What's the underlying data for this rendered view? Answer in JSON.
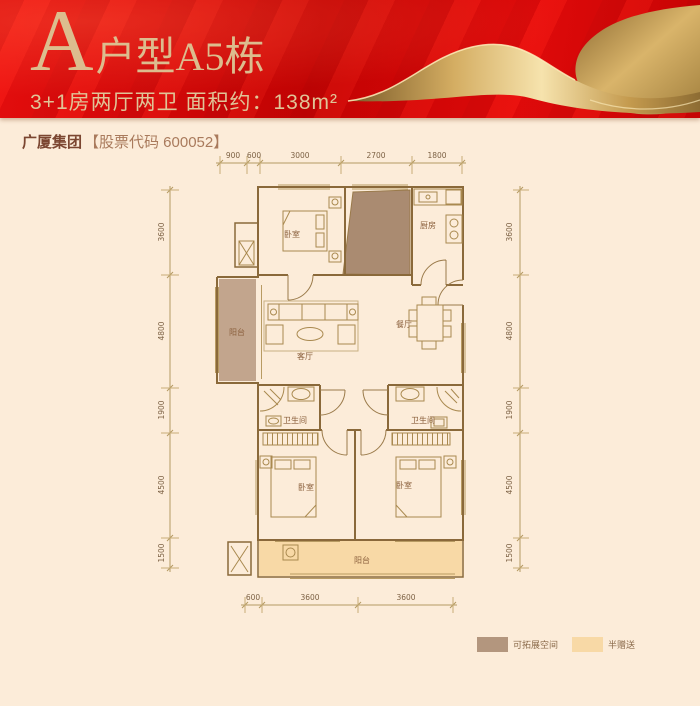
{
  "header": {
    "title_letter": "A",
    "title_rest": "户型A5栋",
    "subtitle": "3+1房两厅两卫 面积约：138m²"
  },
  "company": {
    "name": "广厦集团",
    "stock": "【股票代码 600052】"
  },
  "plan": {
    "rooms": {
      "bedroom_top": "卧室",
      "kitchen": "厨房",
      "balcony_left": "阳台",
      "living": "客厅",
      "dining": "餐厅",
      "bath_left": "卫生间",
      "bath_right": "卫生间",
      "bedroom_left": "卧室",
      "bedroom_right": "卧室",
      "balcony_bottom": "阳台"
    },
    "dims": {
      "top": [
        "900",
        "600",
        "3000",
        "2700",
        "1800"
      ],
      "left": [
        "3600",
        "4800",
        "1900",
        "4500",
        "1500"
      ],
      "right": [
        "3600",
        "4800",
        "1900",
        "4500",
        "1500"
      ],
      "bottom": [
        "600",
        "3600",
        "3600"
      ]
    }
  },
  "legend": [
    {
      "label": "可拓展空间",
      "color": "#b3967e"
    },
    {
      "label": "半赠送",
      "color": "#f8d9a6"
    }
  ],
  "colors": {
    "banner_red": "#d90606",
    "title_gold": "#dcbd8e",
    "background": "#fcecd9",
    "wall": "#8a693a",
    "expand_fill": "#aa8b71",
    "balcony_left_fill": "#c2a58d",
    "gift_fill": "#f8d9a6"
  }
}
